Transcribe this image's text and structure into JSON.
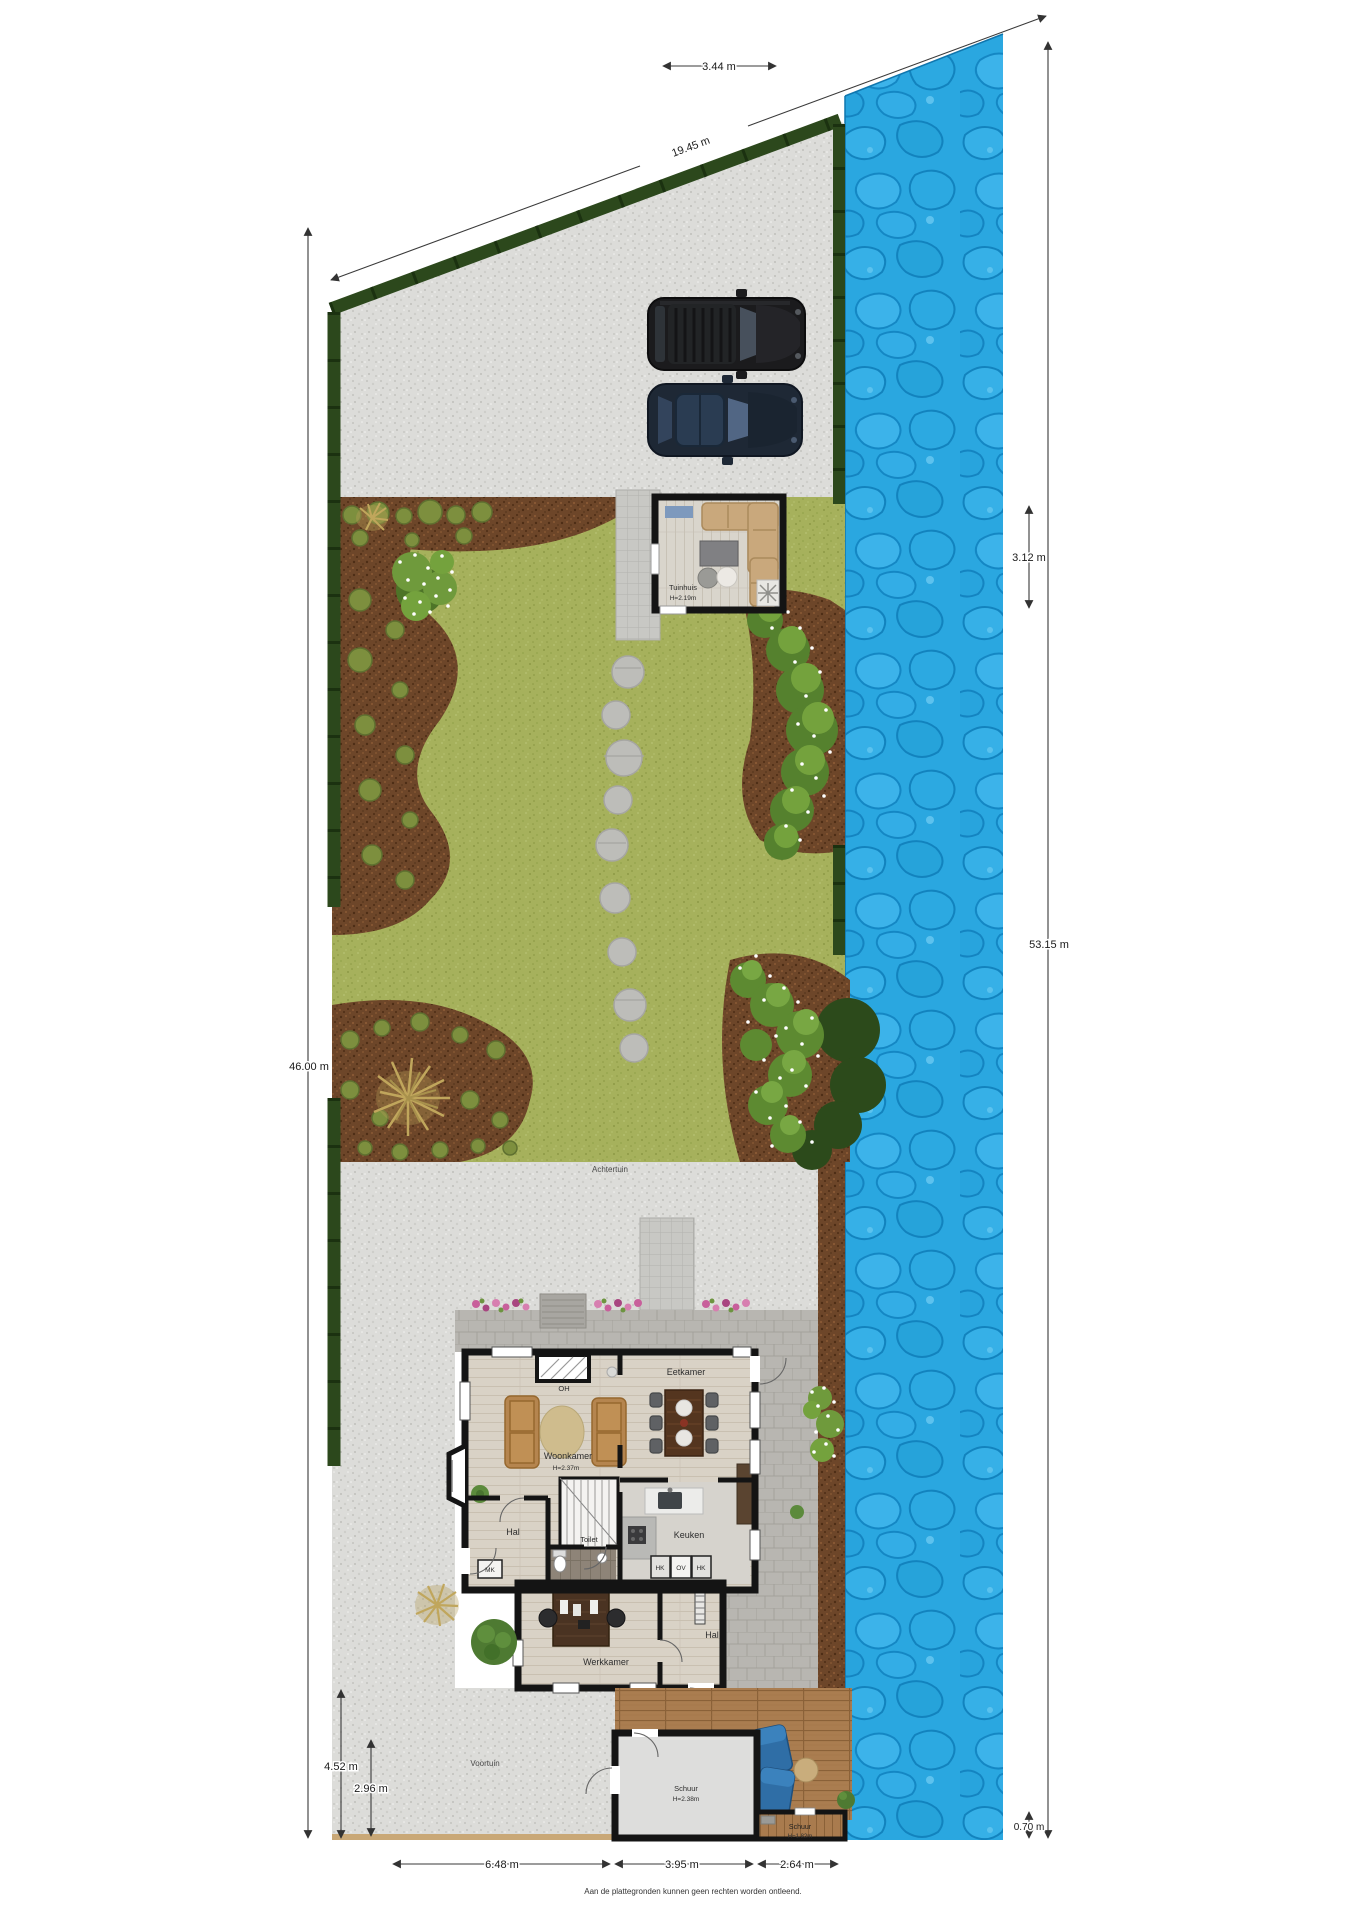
{
  "disclaimer": "Aan de plattegronden kunnen geen rechten worden ontleend.",
  "dimensions": {
    "top_width": "3.44 m",
    "boundary": "19.45 m",
    "water_top": "3.12 m",
    "right_total": "53.15 m",
    "left_total": "46.00 m",
    "front_height": "4.52 m",
    "front_inner": "2.96 m",
    "bottom_left": "6.48 m",
    "bottom_mid": "3.95 m",
    "bottom_right": "2.64 m",
    "water_bottom": "0.70 m"
  },
  "areas": {
    "backyard": "Achtertuin",
    "frontyard": "Voortuin"
  },
  "rooms": {
    "tuinhuis": {
      "label": "Tuinhuis",
      "height": "H=2.19m"
    },
    "woonkamer": {
      "label": "Woonkamer",
      "height": "H=2.37m"
    },
    "eetkamer": {
      "label": "Eetkamer"
    },
    "keuken": {
      "label": "Keuken"
    },
    "hal": {
      "label": "Hal"
    },
    "hal2": {
      "label": "Hal"
    },
    "toilet": {
      "label": "Toilet"
    },
    "werkkamer": {
      "label": "Werkkamer"
    },
    "schuur_groot": {
      "label": "Schuur",
      "height": "H=2.38m"
    },
    "schuur_klein": {
      "label": "Schuur",
      "height": "H=1.82m"
    },
    "fireplace": "OH",
    "mk": "MK",
    "hk1": "HK",
    "ov": "OV",
    "hk2": "HK"
  },
  "colors": {
    "water": "#2aa7e0",
    "grass": "#a6b15c",
    "gravel": "#dcdcd9",
    "soil": "#6d4629",
    "hedge": "#2c481c",
    "wall": "#141414",
    "deck": "#aa7d50"
  }
}
